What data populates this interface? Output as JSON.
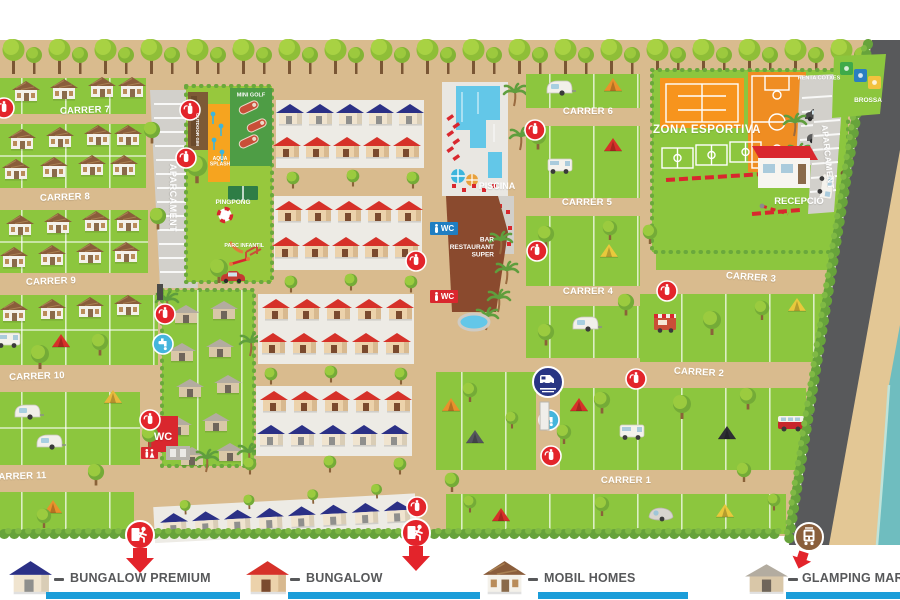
{
  "streets": {
    "c1": "CARRER 1",
    "c2": "CARRER 2",
    "c3": "CARRER 3",
    "c4": "CARRER 4",
    "c5": "CARRER 5",
    "c6": "CARRER 6",
    "c7": "CARRER 7",
    "c8": "CARRER 8",
    "c9": "CARRER 9",
    "c10": "CARRER 10",
    "c11": "CARRER 11"
  },
  "facilities": {
    "aparcament": "APARCAMENT",
    "outdoor_gym": "OUTDOOR GIM",
    "mini_golf": "MINI GOLF",
    "aqua_splash": "AQUA SPLASH",
    "pingpong": "PINGPONG",
    "parc_infantil": "PARC INFANTIL",
    "piscina": "PISCINA",
    "wc": "WC",
    "bar": "BAR RESTAURANT SUPER",
    "zona_esportiva": "ZONA ESPORTIVA",
    "renta_cotxes": "RENTA COTXES",
    "brossa": "BROSSA",
    "recepcio": "RECEPCIÓ"
  },
  "legend": {
    "items": [
      {
        "id": "bungalow-premium",
        "label": "BUNGALOW PREMIUM",
        "roof_color": "#2b3086"
      },
      {
        "id": "bungalow",
        "label": "BUNGALOW",
        "roof_color": "#d63129"
      },
      {
        "id": "mobil-homes",
        "label": "MOBIL HOMES",
        "roof_color": "#8a5d3b"
      },
      {
        "id": "glamping-mar",
        "label": "GLAMPING MAR",
        "roof_color": "#b3aca0"
      }
    ],
    "bar_color": "#1b9dd9"
  },
  "colors": {
    "path_sand": "#d9bb8e",
    "pitch_green": "#8cc63e",
    "leisure_green": "#97c83d",
    "mini_golf_green": "#4e9d45",
    "aqua_orange": "#f6a41f",
    "pool_blue": "#63c7e8",
    "restaurant_brown": "#8a4a2e",
    "road_gray": "#58595b",
    "beach_sand": "#e3c795",
    "sea_teal": "#6fbdbf",
    "marker_red": "#e3242b",
    "tap_blue": "#45b5dc",
    "service_navy": "#283583",
    "tram_brown": "#8a5f3c",
    "sport_orange": "#f7941d",
    "court_orange": "#ef8d22",
    "wc_red": "#d9272e",
    "wc_blue": "#1f7ec2"
  }
}
